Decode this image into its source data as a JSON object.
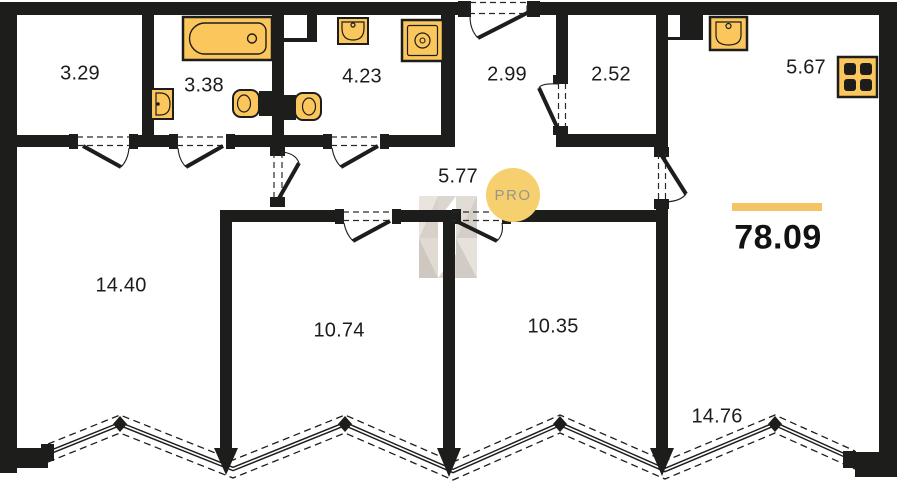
{
  "badge_label": "PRO",
  "total_area": "78.09",
  "rooms": [
    {
      "area": "3.29"
    },
    {
      "area": "3.38"
    },
    {
      "area": "4.23"
    },
    {
      "area": "2.99"
    },
    {
      "area": "2.52"
    },
    {
      "area": "5.67"
    },
    {
      "area": "5.77"
    },
    {
      "area": "14.40"
    },
    {
      "area": "10.74"
    },
    {
      "area": "10.35"
    },
    {
      "area": "14.76"
    }
  ],
  "fixtures": [
    "bathtub-icon",
    "wall-sink-icon",
    "toilet-icon",
    "toilet-icon",
    "sink-icon",
    "washing-machine-icon",
    "kitchen-sink-icon",
    "stove-icon"
  ],
  "colors": {
    "wall": "#1d1d1b",
    "fixture_fill": "#fbc75c",
    "accent_bar": "#f3c364",
    "badge_fill": "#f6cf6e",
    "badge_text": "#97968e"
  }
}
